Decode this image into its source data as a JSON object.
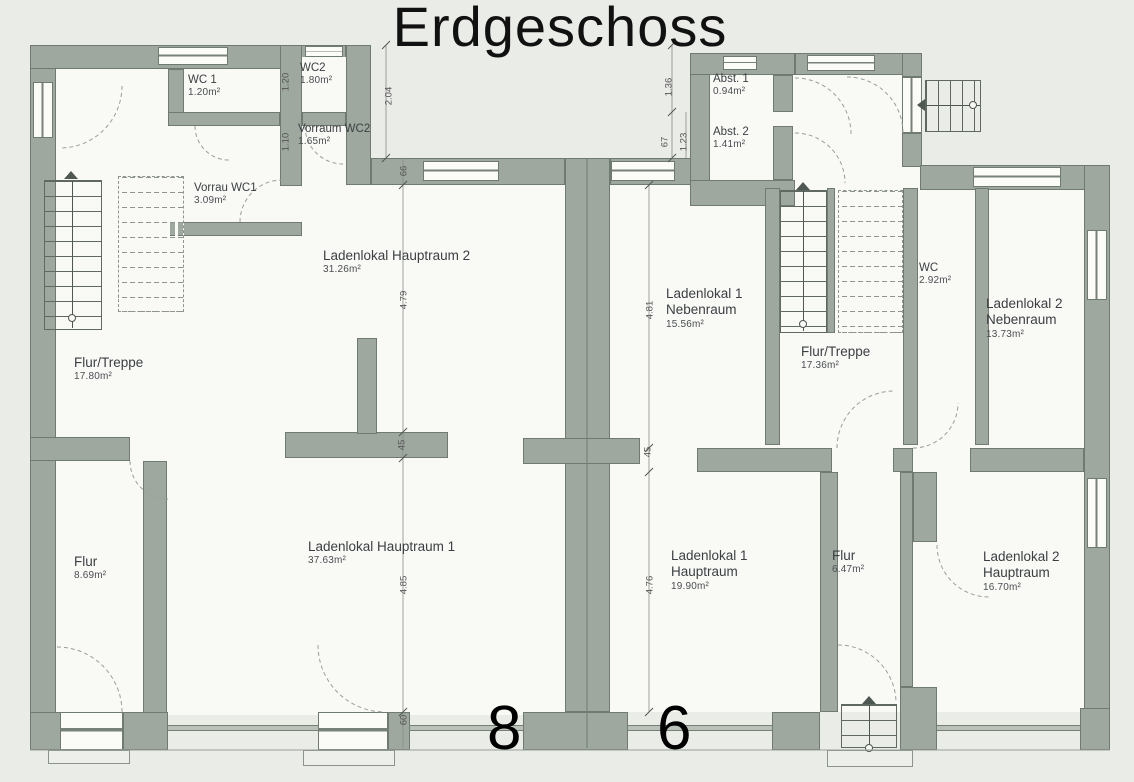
{
  "title": "Erdgeschoss",
  "house_numbers": {
    "left": "8",
    "right": "6"
  },
  "colors": {
    "wall": "#9ea89f",
    "wall_outline": "#6f7a71",
    "page_background": "#eaece7",
    "room_background": "#f9f9f6",
    "label_text": "#3b3f42",
    "dimension_text": "#555555",
    "title_text": "#111111"
  },
  "rooms": [
    {
      "name": "WC 1",
      "area": "1.20m²"
    },
    {
      "name": "WC2",
      "area": "1.80m²"
    },
    {
      "name": "Vorraum WC2",
      "area": "1.65m²"
    },
    {
      "name": "Vorrau WC1",
      "area": "3.09m²"
    },
    {
      "name": "Ladenlokal Hauptraum 2",
      "area": "31.26m²"
    },
    {
      "name": "Flur/Treppe",
      "area": "17.80m²"
    },
    {
      "name": "Flur",
      "area": "8.69m²"
    },
    {
      "name": "Ladenlokal Hauptraum 1",
      "area": "37.63m²"
    },
    {
      "name": "Abst. 1",
      "area": "0.94m²"
    },
    {
      "name": "Abst. 2",
      "area": "1.41m²"
    },
    {
      "name": "Ladenlokal 1 Nebenraum",
      "area": "15.56m²"
    },
    {
      "name": "Flur/Treppe",
      "area": "17.36m²"
    },
    {
      "name": "WC",
      "area": "2.92m²"
    },
    {
      "name": "Ladenlokal 2 Nebenraum",
      "area": "13.73m²"
    },
    {
      "name": "Ladenlokal 1 Hauptraum",
      "area": "19.90m²"
    },
    {
      "name": "Flur",
      "area": "6.47m²"
    },
    {
      "name": "Ladenlokal 2 Hauptraum",
      "area": "16.70m²"
    }
  ],
  "dimensions": [
    {
      "value": "1.20"
    },
    {
      "value": "1.10"
    },
    {
      "value": "2.04"
    },
    {
      "value": "66"
    },
    {
      "value": "4.79"
    },
    {
      "value": "45"
    },
    {
      "value": "4.85"
    },
    {
      "value": "60"
    },
    {
      "value": "1.36"
    },
    {
      "value": "67"
    },
    {
      "value": "1.23"
    },
    {
      "value": "4.81"
    },
    {
      "value": "45"
    },
    {
      "value": "4.76"
    }
  ]
}
